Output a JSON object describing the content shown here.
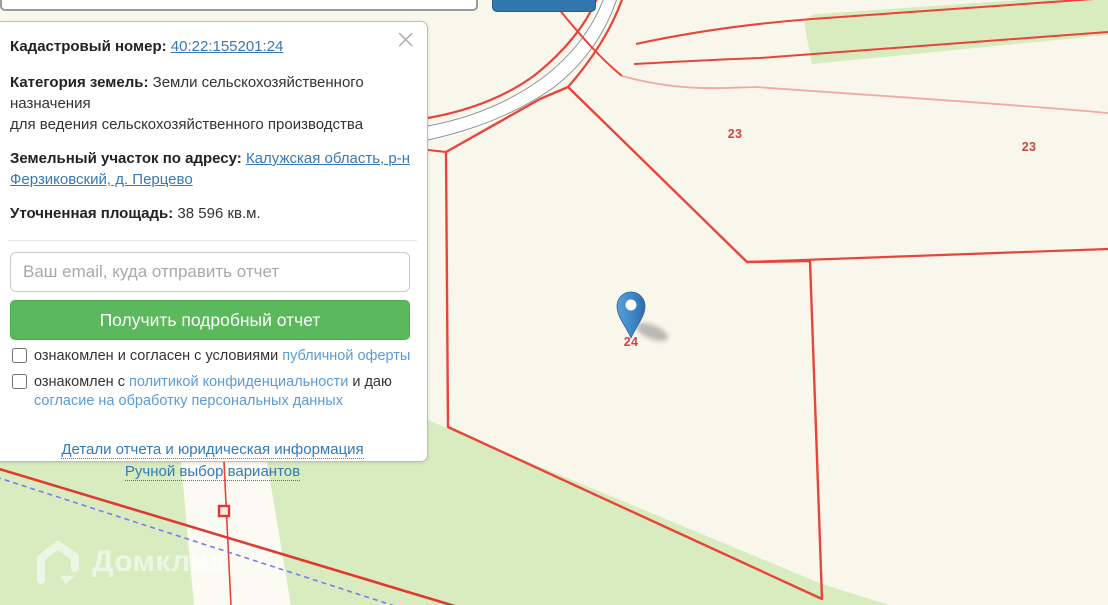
{
  "search": {
    "placeholder": "Введите кадастровый номер или адрес земельного участка",
    "button_label": ""
  },
  "panel": {
    "close_icon": "×",
    "cadastral_label": "Кадастровый номер:",
    "cadastral_number": "40:22:155201:24",
    "category_label": "Категория земель:",
    "category_value": "Земли сельскохозяйственного назначения",
    "category_note": "для ведения сельскохозяйственного производства",
    "address_label": "Земельный участок по адресу:",
    "address_link": "Калужская область, р-н Ферзиковский, д. Перцево",
    "area_label": "Уточненная площадь:",
    "area_value": "38 596 кв.м.",
    "email_placeholder": "Ваш email, куда отправить отчет",
    "submit_label": "Получить подробный отчет",
    "consent1_text": "ознакомлен и согласен с условиями ",
    "consent1_link": "публичной оферты",
    "consent2_text": "ознакомлен с ",
    "consent2_link": "политикой конфиденциальности",
    "consent2_text2": " и даю ",
    "consent2_link2": "согласие на обработку персональных данных",
    "details_link": "Детали отчета и юридическая информация",
    "manual_link": "Ручной выбор вариантов"
  },
  "map": {
    "watermark": "Домклик",
    "parcel_labels": [
      {
        "text": "23",
        "x": 735,
        "y": 134
      },
      {
        "text": "23",
        "x": 1029,
        "y": 147
      },
      {
        "text": "24",
        "x": 631,
        "y": 342
      }
    ],
    "colors": {
      "background": "#f9f7ec",
      "forest_green": "#d8ecc0",
      "boundary_red": "#e8443a",
      "faint_boundary_pink": "#f1a9a4",
      "admin_dashed_blue": "#7b7bf0",
      "pin_blue": "#3e86c7",
      "link_blue": "#337ab7",
      "soft_link_blue": "#5b9bd5",
      "button_green": "#5cb85c",
      "search_button_blue": "#3176ad"
    }
  }
}
